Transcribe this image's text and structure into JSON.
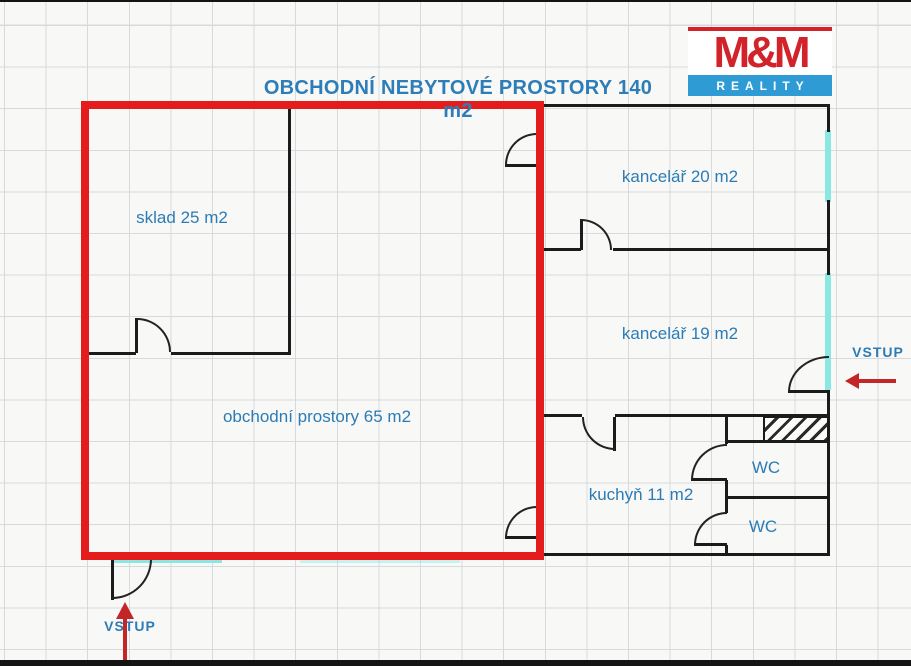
{
  "title": "OBCHODNÍ NEBYTOVÉ PROSTORY 140 m2",
  "logo": {
    "name": "M&M",
    "tagline": "REALITY"
  },
  "rooms": [
    {
      "id": "sklad",
      "label": "sklad 25 m2"
    },
    {
      "id": "kancelar20",
      "label": "kancelář 20 m2"
    },
    {
      "id": "kancelar19",
      "label": "kancelář 19 m2"
    },
    {
      "id": "obchodni",
      "label": "obchodní prostory 65 m2"
    },
    {
      "id": "kuchyn",
      "label": "kuchyň 11 m2"
    },
    {
      "id": "wc1",
      "label": "WC"
    },
    {
      "id": "wc2",
      "label": "WC"
    }
  ],
  "entrances": [
    {
      "id": "bottom-left",
      "label": "VSTUP"
    },
    {
      "id": "right",
      "label": "VSTUP"
    }
  ],
  "colors": {
    "highlight_red": "#e51c1c",
    "arrow_red": "#c22626",
    "window_cyan": "#8ae8e3",
    "wall_black": "#1b1b1b",
    "text_blue": "#2b7cb6",
    "logo_red": "#d2232a",
    "logo_blue": "#2e9bd5"
  }
}
